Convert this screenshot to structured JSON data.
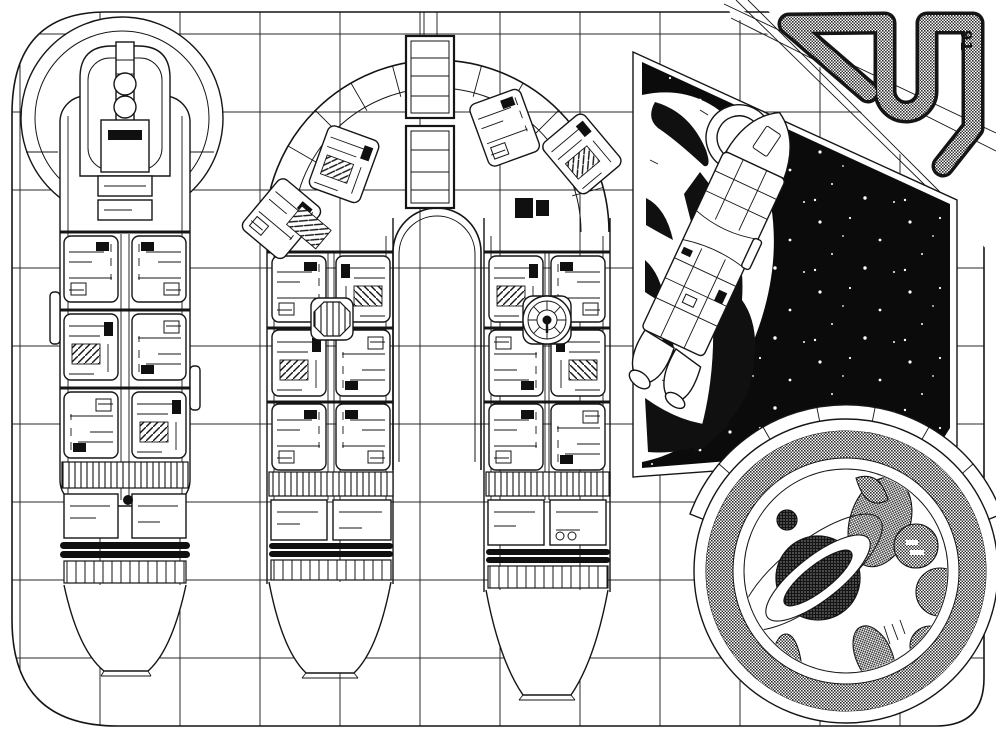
{
  "page": {
    "number": "91"
  },
  "palette": {
    "ink": "#141414",
    "paper": "#ffffff",
    "space_black": "#0b0b0b",
    "halftone_gray": "#3c3c3c"
  }
}
